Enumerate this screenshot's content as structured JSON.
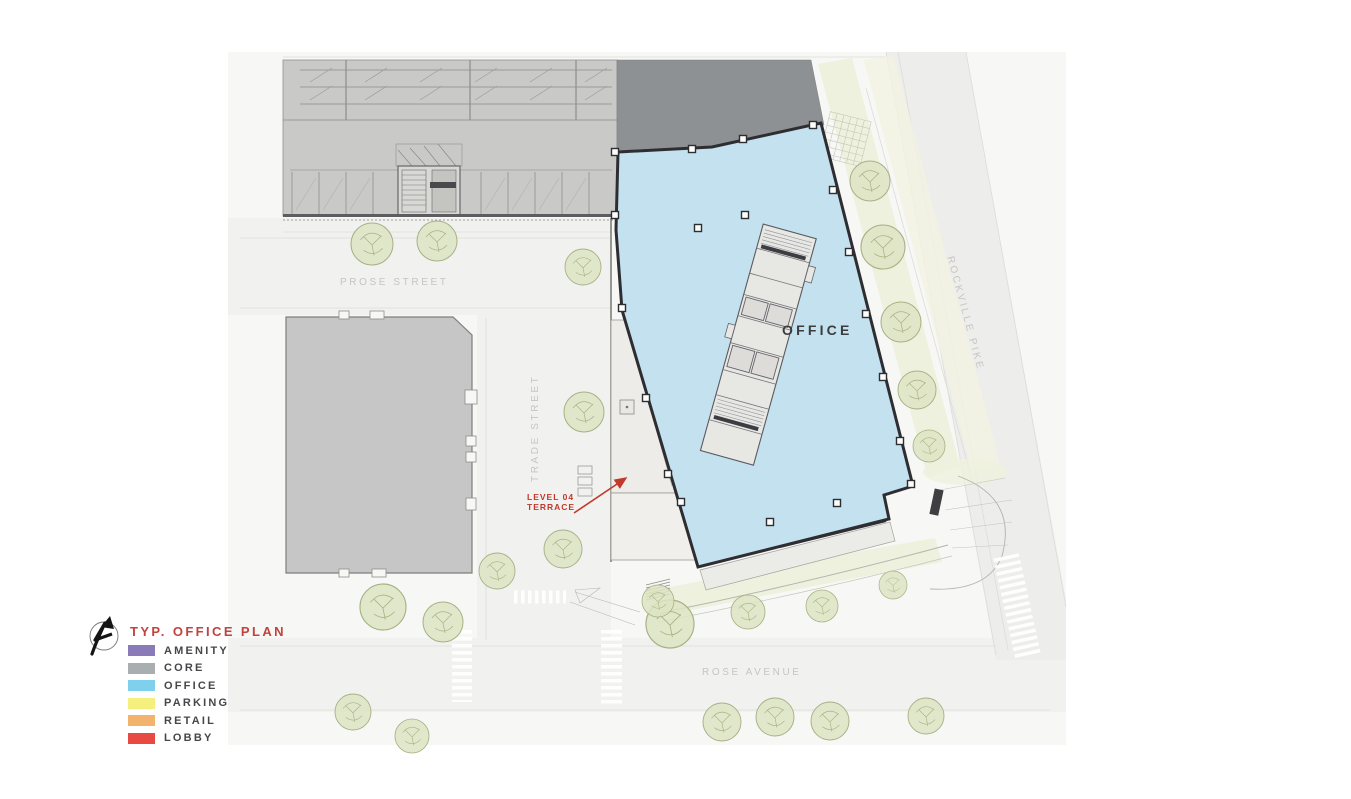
{
  "legend": {
    "title": "TYP. OFFICE PLAN",
    "title_color": "#c2423d",
    "items": [
      {
        "label": "AMENITY",
        "color": "#8a7ab8"
      },
      {
        "label": "CORE",
        "color": "#a9aeb0"
      },
      {
        "label": "OFFICE",
        "color": "#7ed0ec"
      },
      {
        "label": "PARKING",
        "color": "#f5f07d"
      },
      {
        "label": "RETAIL",
        "color": "#f2b46d"
      },
      {
        "label": "LOBBY",
        "color": "#e84a43"
      }
    ]
  },
  "plan": {
    "building_label": "OFFICE",
    "annotation": {
      "line1": "LEVEL 04",
      "line2": "TERRACE",
      "color": "#c0392b"
    },
    "streets": {
      "north": "PROSE STREET",
      "west": "TRADE STREET",
      "south": "ROSE AVENUE",
      "east": "ROCKVILLE PIKE"
    },
    "colors": {
      "office_fill": "#c3e1ee",
      "core_fill": "#e7e7e3",
      "garage_fill": "#c9cac8",
      "dark_block_fill": "#8e9193",
      "building_gray_fill": "#c5c6c5",
      "tree_fill": "#dde4c3",
      "annotation_red": "#c0392b"
    }
  }
}
